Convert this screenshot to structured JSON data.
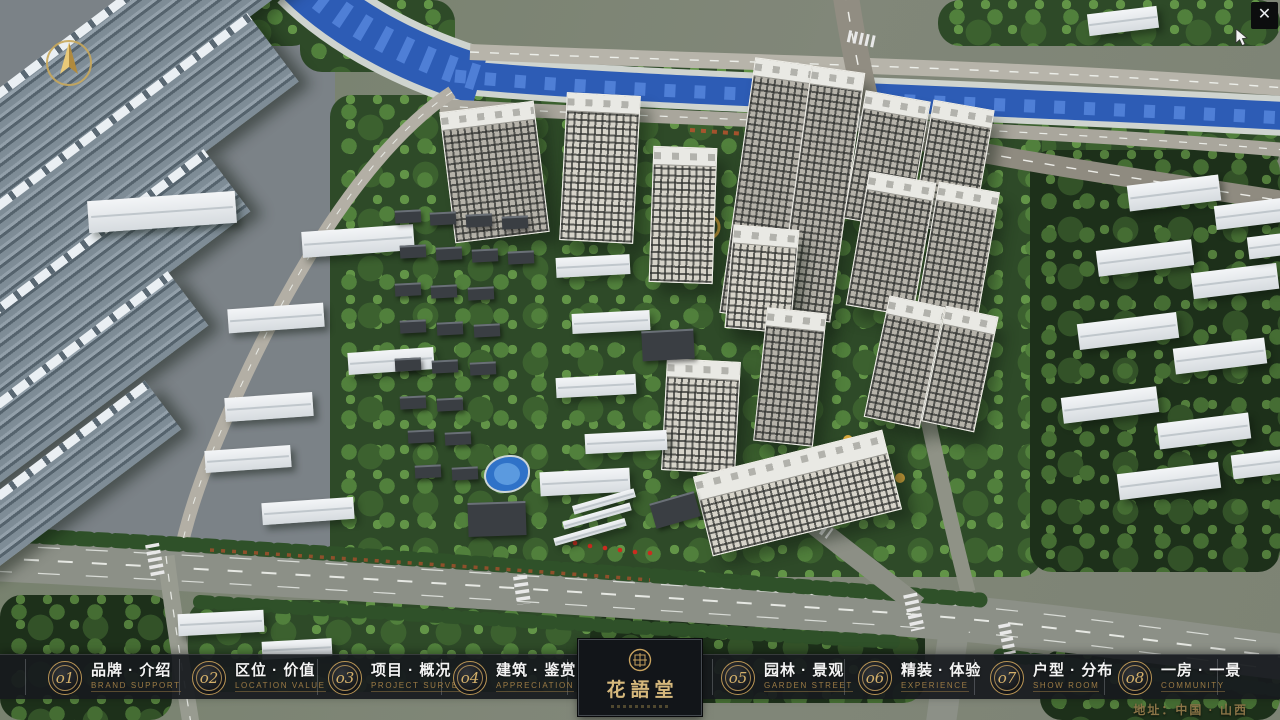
{
  "window": {
    "close_icon": "✕"
  },
  "navbar": {
    "items": [
      {
        "number": "o1",
        "label_cn": "品牌 · 介绍",
        "label_en": "BRAND SUPPORT"
      },
      {
        "number": "o2",
        "label_cn": "区位 · 价值",
        "label_en": "LOCATION VALUE"
      },
      {
        "number": "o3",
        "label_cn": "项目 · 概况",
        "label_en": "PROJECT SURVEY"
      },
      {
        "number": "o4",
        "label_cn": "建筑 · 鉴赏",
        "label_en": "APPRECIATION"
      },
      {
        "number": "o5",
        "label_cn": "园林 · 景观",
        "label_en": "GARDEN STREET"
      },
      {
        "number": "o6",
        "label_cn": "精装 · 体验",
        "label_en": "EXPERIENCE"
      },
      {
        "number": "o7",
        "label_cn": "户型 · 分布",
        "label_en": "SHOW ROOM"
      },
      {
        "number": "o8",
        "label_cn": "一房 · 一景",
        "label_en": "COMMUNITY"
      }
    ]
  },
  "logo": {
    "title": "花語堂"
  },
  "footer": {
    "address": "地址：中国 · 山西"
  },
  "colors": {
    "accent_gold": "#c9a35f",
    "navbar_bg": "#171a1e",
    "river_blue": "#2d5cb5",
    "foliage_green": "#2e4a28",
    "road_gray": "#8c9087",
    "tower_face": "#d6d3c9"
  }
}
